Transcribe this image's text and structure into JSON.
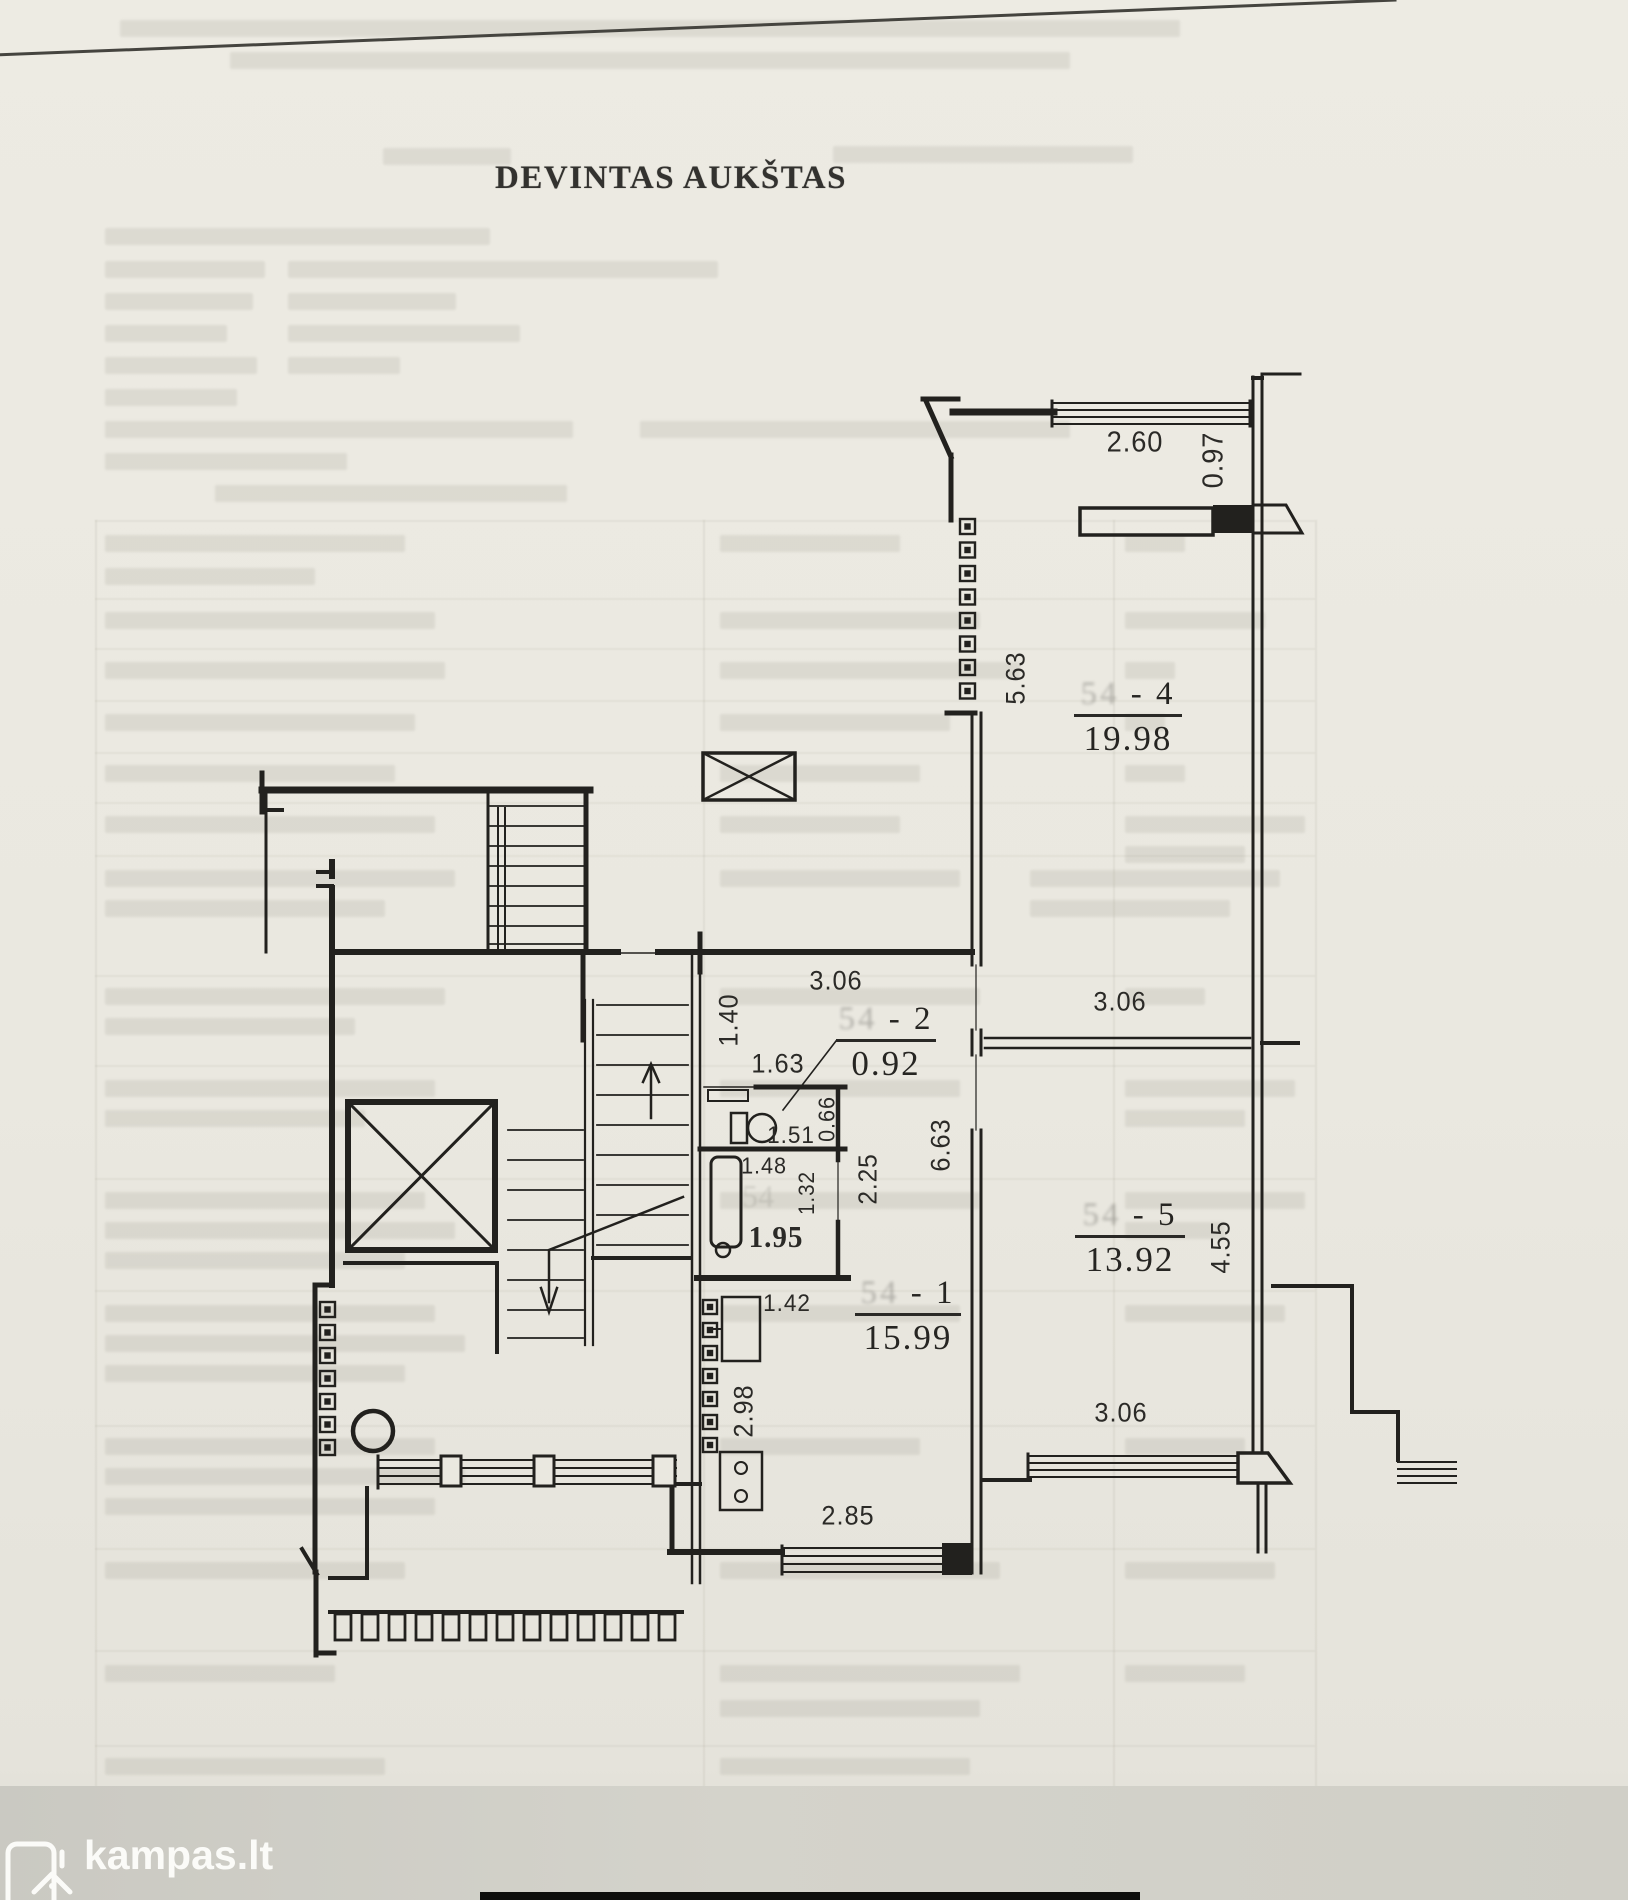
{
  "document": {
    "title": "DEVINTAS AUKŠTAS"
  },
  "floor_plan": {
    "rooms": [
      {
        "number": "54 - 4",
        "area": "19.98"
      },
      {
        "number": "54 - 2",
        "area": "0.92"
      },
      {
        "number": "54 - 5",
        "area": "13.92"
      },
      {
        "number": "54 - 1",
        "area": "15.99"
      }
    ],
    "dim_labels": [
      {
        "text": "2.60"
      },
      {
        "text": "0.97"
      },
      {
        "text": "5.63"
      },
      {
        "text": "3.06"
      },
      {
        "text": "1.40"
      },
      {
        "text": "1.63"
      },
      {
        "text": "0.66"
      },
      {
        "text": "1.51"
      },
      {
        "text": "3.06"
      },
      {
        "text": "6.63"
      },
      {
        "text": "2.25"
      },
      {
        "text": "1.48"
      },
      {
        "text": "1.32"
      },
      {
        "text": "1.95"
      },
      {
        "text": "4.55"
      },
      {
        "text": "1.42"
      },
      {
        "text": "2.98"
      },
      {
        "text": "2.85"
      },
      {
        "text": "3.06"
      }
    ],
    "faint_stamp": "54"
  },
  "watermark": {
    "brand": "kampas.lt"
  }
}
